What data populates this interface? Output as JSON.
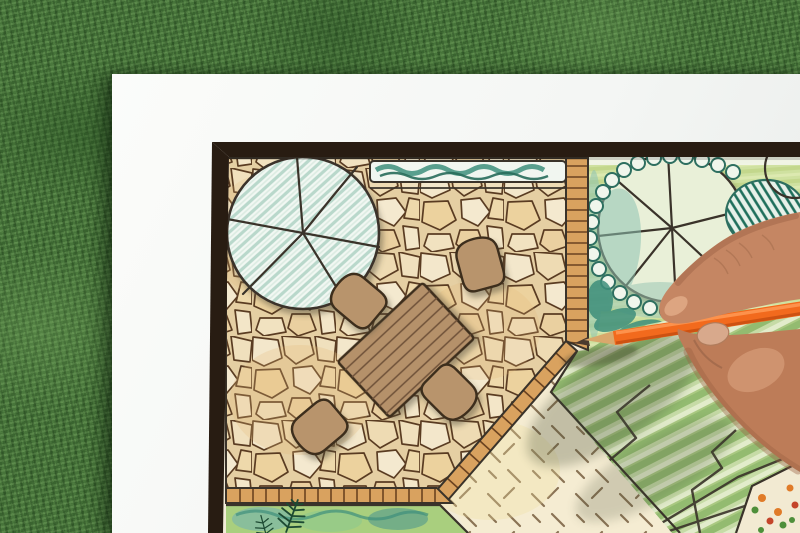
{
  "scene": {
    "type": "photograph",
    "description": "Overhead view of a hand drawing a backyard garden landscape-architecture plan with an orange colored pencil on a white sheet lying on green grass",
    "background": "green lawn grass",
    "surface": "white paper sheet with dark-framed plan drawing",
    "action": "hand coloring the plan with an orange pencil"
  },
  "elements": [
    "picture-frame-border",
    "flagstone-patio",
    "tree-canopy-symbol-large",
    "tree-canopy-symbol-right",
    "hedge-strip",
    "dining-table",
    "four-chairs",
    "tile-edge-strips",
    "gravel-area-with-dashes",
    "striped-lawn",
    "planting-beds",
    "fern-symbols",
    "shrub-scallops",
    "hand",
    "orange-pencil"
  ],
  "colors": {
    "grass_base": "#47743a",
    "paper": "#f6f7f4",
    "frame": "#281c12",
    "plan_paper": "#f2ebd8",
    "stone_bg": "#e5cfa3",
    "stone_line": "#5a3c22",
    "ink": "#3a332a",
    "tile_edge": "#d9a25f",
    "tile_edge_line": "#6b4320",
    "hedge_fill": "#f1f6f0",
    "hedge_teal": "#3e8f7c",
    "hedge_teal_dark": "#276b5a",
    "canopy_fill": "#f2f8f3",
    "canopy_hatch": "#b9d8cb",
    "table_wood": "#b5916a",
    "chair_wood": "#b8946c",
    "wood_line": "#6e5138",
    "furniture_outline": "#3c2d1e",
    "garden_green": "#cfe1a0",
    "lawn_dark": "#93bb70",
    "lawn_light": "#e2eccb",
    "gravel_bg": "#f5ecd2",
    "gravel_dash": "#8a7355",
    "shrub_teal": "#2e6f60",
    "shrub_teal_light": "#8fc3b2",
    "bed_wash": "#a9cf7e",
    "fern_green": "#1d4a33",
    "flower_orange": "#e07b28",
    "flower_red": "#c4452a",
    "flower_green": "#4e8f3a",
    "pencil_orange": "#f26a1d",
    "pencil_orange_light": "#ff9a55",
    "pencil_orange_dark": "#c44d10",
    "pencil_wood": "#d9a86c",
    "pencil_lead": "#4a3a2e",
    "skin_index": "#c58663",
    "skin_palm": "#bd7c58",
    "skin_shadow": "#9c6144",
    "skin_highlight": "#e4af8b",
    "nail": "#d8a98c",
    "shadow": "#4a4436"
  }
}
